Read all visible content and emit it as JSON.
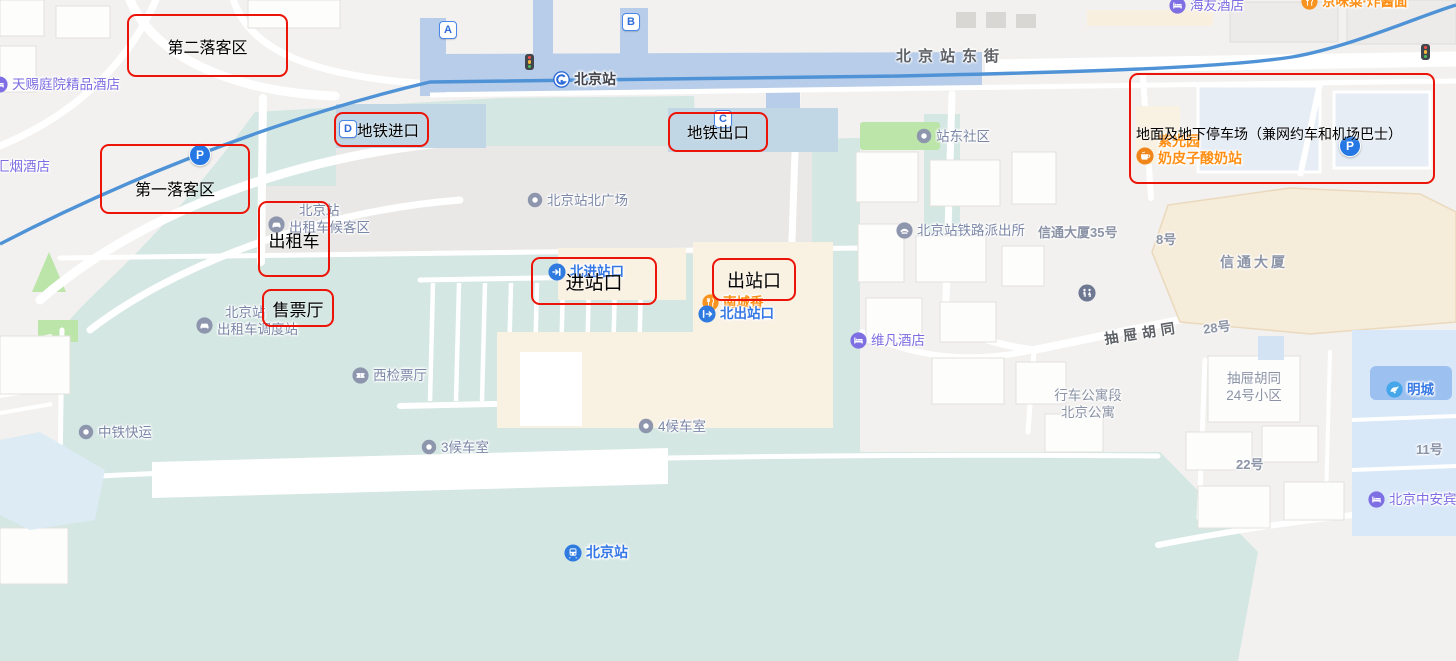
{
  "annotations": [
    {
      "label": "第二落客区"
    },
    {
      "label": "第一落客区"
    },
    {
      "label": "地铁进口"
    },
    {
      "label": "地铁出口"
    },
    {
      "label": "出租车"
    },
    {
      "label": "售票厅"
    },
    {
      "label": "进站口"
    },
    {
      "label": "出站口"
    },
    {
      "label": "地面及地下停车场（兼网约车和机场巴士）"
    }
  ],
  "exits": {
    "a": "A",
    "b": "B",
    "c": "C",
    "d": "D"
  },
  "misc": {
    "parking_letter": "P"
  },
  "streets": [
    {
      "name": "北京站东街"
    },
    {
      "name": "抽屉胡同"
    }
  ],
  "texts": [
    {
      "label": "信通大厦35号"
    },
    {
      "label": "8号"
    },
    {
      "label": "信通大厦"
    },
    {
      "label": "28号"
    },
    {
      "label": "22号"
    },
    {
      "label": "11号"
    }
  ],
  "pois": [
    {
      "label": "天赐庭院精品酒店"
    },
    {
      "label": "汇烟酒店"
    },
    {
      "label": "海友酒店"
    },
    {
      "label": "京味菜·炸酱面"
    },
    {
      "label": "北京站"
    },
    {
      "label": "站东社区"
    },
    {
      "label": "北京站北广场"
    },
    {
      "label": "北京站铁路派出所"
    },
    {
      "label": "北京站",
      "label2": "出租车候客区"
    },
    {
      "label": "南城香"
    },
    {
      "label": "北进站口"
    },
    {
      "label": "北出站口"
    },
    {
      "label": "维凡酒店"
    },
    {
      "label": "北京站",
      "label2": "出租车调度站"
    },
    {
      "label": "西检票厅"
    },
    {
      "label": "中铁快运"
    },
    {
      "label": "3候车室"
    },
    {
      "label": "4候车室"
    },
    {
      "label": "北京站"
    },
    {
      "label": "行车公寓段",
      "label2": "北京公寓"
    },
    {
      "label": "抽屉胡同",
      "label2": "24号小区"
    },
    {
      "label": "明城"
    },
    {
      "label": "北京中安宾"
    },
    {
      "label": "紫光园",
      "label2": "奶皮子酸奶站"
    }
  ],
  "colors": {
    "annotation_red": "#ec1408",
    "station_teal": "#d4e7e3",
    "metro_line_blue": "#4f93d6",
    "poi_blue": "#3578e5",
    "poi_purple": "#7d6ce2",
    "poi_orange": "#ff8f14",
    "road_white": "#ffffff"
  }
}
